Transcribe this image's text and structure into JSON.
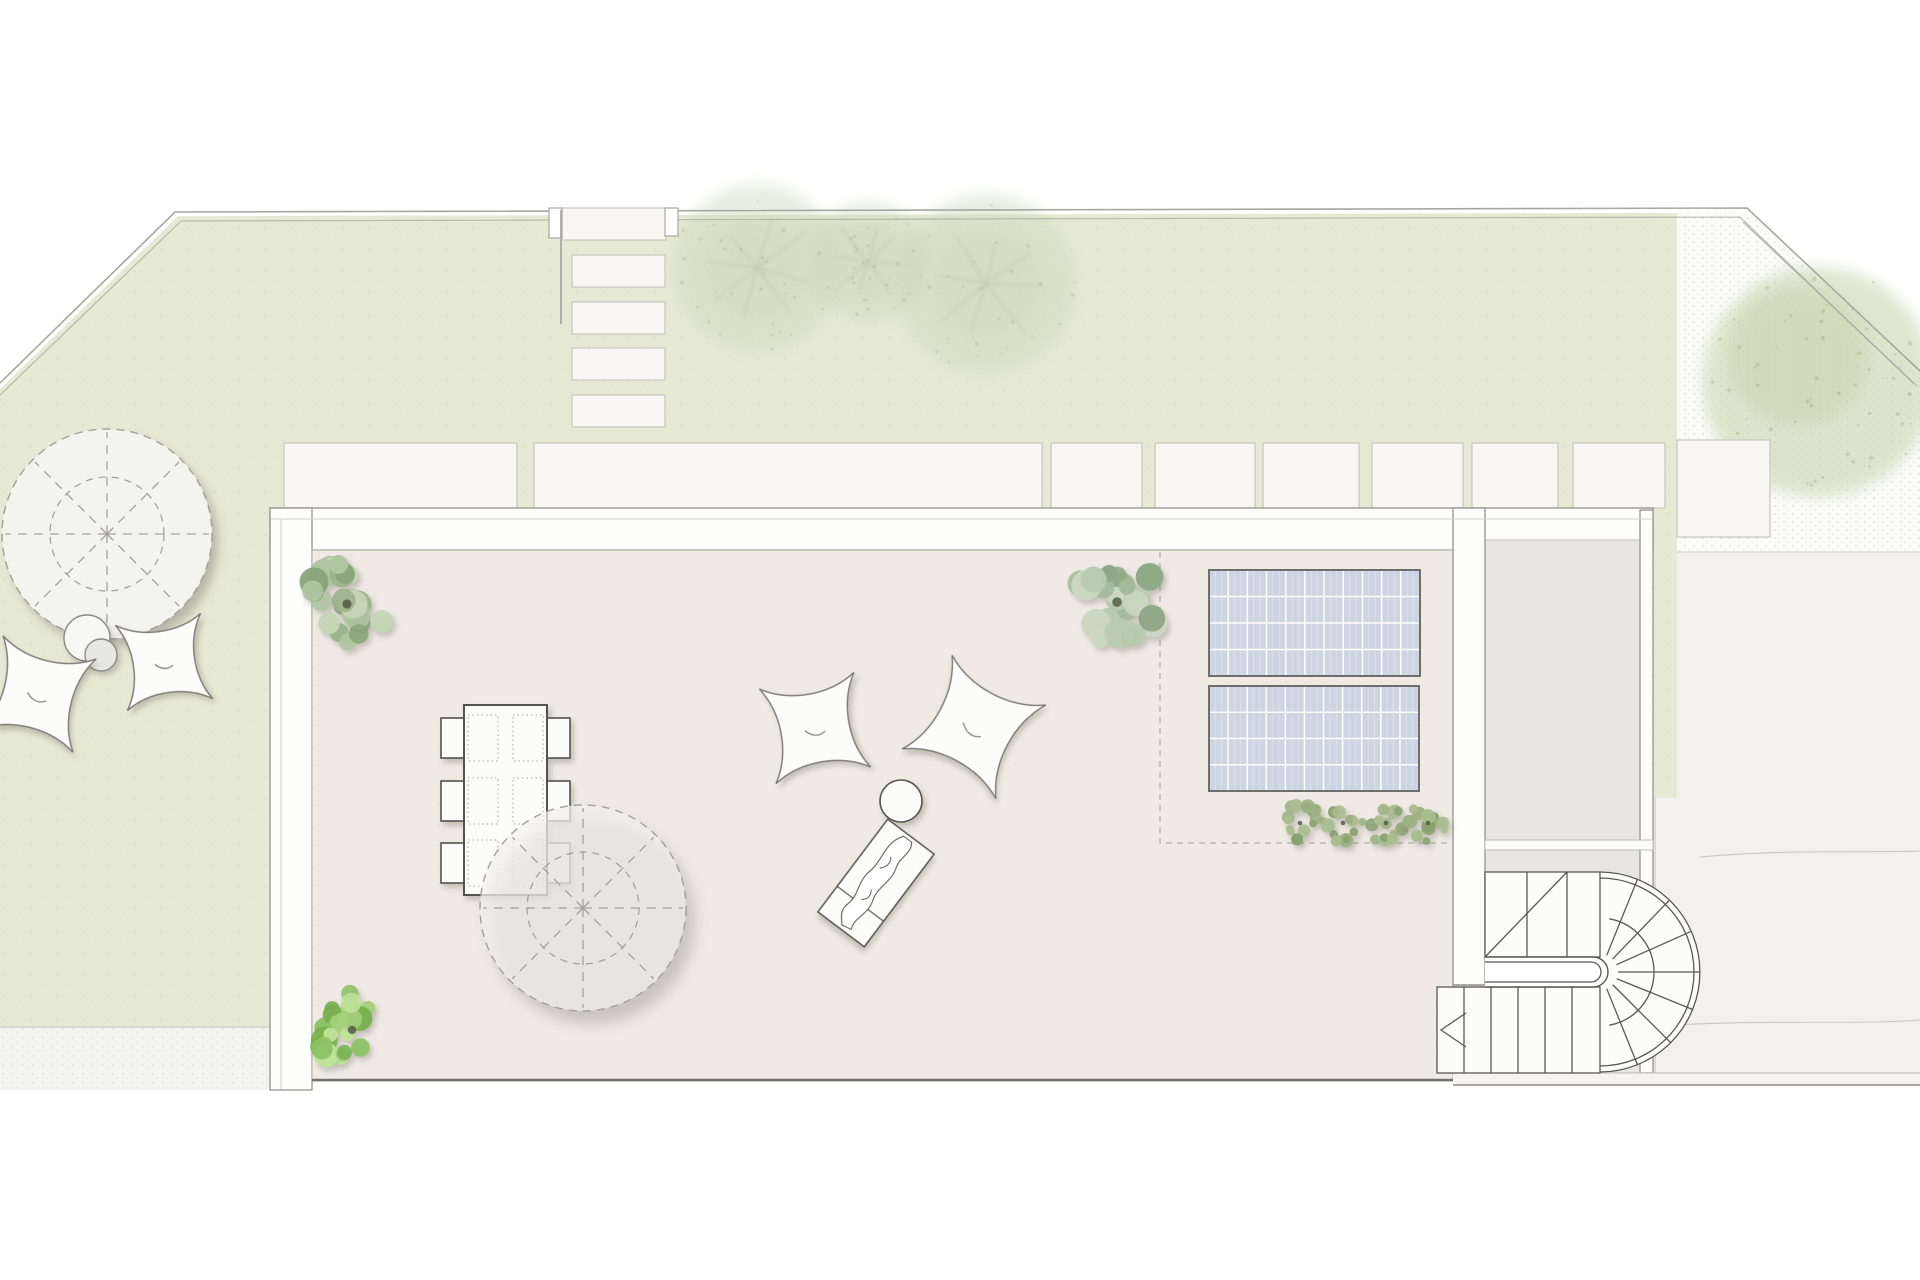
{
  "canvas": {
    "w": 1920,
    "h": 1280,
    "bg": "#ffffff"
  },
  "colors": {
    "lawn": "#e6e9d4",
    "boundary": "#a7a7a1",
    "paverFill": "#f8f7f3",
    "paverLine": "#c6c6c0",
    "gravelRight": "#fbfbf8",
    "gravelLeft": "#f3f4ee",
    "drive": "#f2f1ed",
    "driveLine": "#cbc9c4",
    "wallFill": "#fdfdfc",
    "wallLine": "#9b9b97",
    "wallInnerLine": "#d0cec9",
    "terraceFloor": "#efeae4",
    "annexFloor": "#e9e6e1",
    "floorEdge": "#b8b4ad",
    "darkEdge": "#74726e",
    "panelFill": "#ced5e2",
    "panelBorder": "#6e6e6c",
    "panelGrid": "#ffffff",
    "dashZone": "#b3b0a9",
    "furnLine": "#55534f",
    "furnFill": "#fcfcfa",
    "parasolDash": "#a3a29a",
    "parasolFillLawn": "#f4f4ee",
    "parasolFillTerrace": "rgba(243,241,234,0.72)",
    "treeSoftFill": "#cbd6b5",
    "treeSoftLine": "#a9ba92",
    "bigTreeFill": "#bfcfa2",
    "stair": "#5a5854",
    "shadow": "#6f6a5f"
  },
  "boundary": {
    "outer": "M 0 383 L 175 212 L 1747 208 L 1920 371",
    "inner": "M 0 395 L 181 221 L 1740 217 L 1914 384"
  },
  "lawn": {
    "points": "0,389 178,216 1677,213 1677,798 1655,798 1655,1027 0,1027"
  },
  "gravel_right": {
    "points": "1677,213 1747,210 1920,372 1920,552 1677,552",
    "inner_diag": "M 1743 222 L 1917 386"
  },
  "gravel_left": {
    "x": 0,
    "y": 1027,
    "w": 270,
    "h": 63
  },
  "driveway": {
    "x": 1677,
    "y": 552,
    "w": 243,
    "h": 533,
    "sliver": {
      "x": 1653,
      "y": 798,
      "w": 24,
      "h": 287
    },
    "top_line": "M 1677 552 L 1920 552",
    "seam1": "M 1700 857 C 1790 849 1862 853 1920 851",
    "seam2": "M 1655 1026 C 1770 1019 1852 1025 1920 1020",
    "vline": "M 1655 798 L 1655 1085"
  },
  "entry": {
    "steps": [
      {
        "x": 562,
        "y": 208,
        "w": 104,
        "h": 32
      },
      {
        "x": 572,
        "y": 255,
        "w": 93,
        "h": 32
      },
      {
        "x": 572,
        "y": 302,
        "w": 93,
        "h": 32
      },
      {
        "x": 572,
        "y": 348,
        "w": 93,
        "h": 32
      },
      {
        "x": 572,
        "y": 395,
        "w": 93,
        "h": 32
      }
    ],
    "gate_posts": [
      {
        "x": 549,
        "y": 208,
        "w": 13,
        "h": 30
      },
      {
        "x": 665,
        "y": 208,
        "w": 13,
        "h": 28
      }
    ],
    "retaining_line": "M 561 210 L 561 324"
  },
  "pavers": [
    {
      "x": 284,
      "y": 443,
      "w": 233,
      "h": 65
    },
    {
      "x": 534,
      "y": 443,
      "w": 508,
      "h": 65
    },
    {
      "x": 1051,
      "y": 443,
      "w": 91,
      "h": 65
    },
    {
      "x": 1155,
      "y": 443,
      "w": 100,
      "h": 65
    },
    {
      "x": 1263,
      "y": 443,
      "w": 96,
      "h": 65
    },
    {
      "x": 1372,
      "y": 443,
      "w": 91,
      "h": 65
    },
    {
      "x": 1472,
      "y": 443,
      "w": 86,
      "h": 65
    },
    {
      "x": 1573,
      "y": 443,
      "w": 92,
      "h": 65
    },
    {
      "x": 1677,
      "y": 440,
      "w": 93,
      "h": 97
    }
  ],
  "building": {
    "top_band": {
      "x": 270,
      "y": 508,
      "w": 1383,
      "h": 42
    },
    "left_band": {
      "x": 270,
      "y": 508,
      "w": 42,
      "h": 582
    },
    "mid_wall": {
      "x": 1453,
      "y": 508,
      "w": 32,
      "h": 477
    },
    "annex_right_wall": {
      "x": 1640,
      "y": 510,
      "w": 13,
      "h": 563
    },
    "terrace_floor": {
      "x": 312,
      "y": 550,
      "w": 1141,
      "h": 531
    },
    "annex_floor": {
      "x": 1485,
      "y": 540,
      "w": 155,
      "h": 533
    },
    "annex_band": {
      "x": 1485,
      "y": 840,
      "w": 168,
      "h": 10
    },
    "floor_patch": {
      "x": 1453,
      "y": 985,
      "w": 32,
      "h": 96
    },
    "inner_line_top": "M 271 519 L 1652 519",
    "inner_line_left": "M 281 519 L 281 1089",
    "mid_wall_cap": "M 1453 985 L 1485 985",
    "floor_bottom_line": "M 312 1080 L 1453 1080",
    "stair_bottom_band": {
      "x": 1453,
      "y": 1073,
      "w": 467,
      "h": 12
    }
  },
  "solar": {
    "zone_dash": "M 1160 552 L 1160 843 L 1453 843",
    "panels": [
      {
        "x": 1209,
        "y": 570,
        "w": 211,
        "h": 106
      },
      {
        "x": 1209,
        "y": 686,
        "w": 210,
        "h": 105
      }
    ],
    "cols": 11,
    "rows": 4
  },
  "trees_soft": [
    {
      "cx": 757,
      "cy": 268,
      "r": 84
    },
    {
      "cx": 868,
      "cy": 262,
      "r": 60
    },
    {
      "cx": 986,
      "cy": 284,
      "r": 90
    }
  ],
  "big_tree": {
    "cx": 1818,
    "cy": 382,
    "r": 115
  },
  "plants": [
    {
      "cx": 347,
      "cy": 604,
      "r": 46,
      "n": 26,
      "seed": 7,
      "palette": [
        "#9db58f",
        "#b0c5a1",
        "#87a478",
        "#c6d5b6"
      ]
    },
    {
      "cx": 352,
      "cy": 1030,
      "r": 42,
      "n": 24,
      "seed": 11,
      "palette": [
        "#8cc163",
        "#a5d07c",
        "#79b14e",
        "#c0e29a"
      ]
    },
    {
      "cx": 1117,
      "cy": 602,
      "r": 48,
      "n": 26,
      "seed": 23,
      "palette": [
        "#a3bb9a",
        "#b8cbaf",
        "#8fa887",
        "#cbd8c2"
      ]
    }
  ],
  "hedge": {
    "palette": [
      "#9cb183",
      "#a9bd8f",
      "#8aa271"
    ],
    "n": 14,
    "bushes": [
      {
        "cx": 1300,
        "cy": 823,
        "r": 23,
        "seed": 31
      },
      {
        "cx": 1343,
        "cy": 823,
        "r": 23,
        "seed": 37
      },
      {
        "cx": 1386,
        "cy": 823,
        "r": 23,
        "seed": 41
      },
      {
        "cx": 1428,
        "cy": 823,
        "r": 23,
        "seed": 43
      }
    ]
  },
  "parasols": [
    {
      "cx": 107,
      "cy": 534,
      "r": 105,
      "ri": 57,
      "on": "lawn"
    },
    {
      "cx": 583,
      "cy": 908,
      "r": 103,
      "ri": 56,
      "on": "terrace"
    }
  ],
  "side_tables": [
    {
      "cx": 87,
      "cy": 638,
      "r": 23,
      "fill": "#f7f7f3"
    },
    {
      "cx": 101,
      "cy": 655,
      "r": 16,
      "fill": "#e8e8e3"
    },
    {
      "cx": 901,
      "cy": 801,
      "r": 21,
      "fill": "#fbfbf9"
    }
  ],
  "bean_bags": [
    {
      "cx": 38,
      "cy": 694,
      "s": 48,
      "rot": 14
    },
    {
      "cx": 164,
      "cy": 662,
      "s": 43,
      "rot": -8
    },
    {
      "cx": 815,
      "cy": 728,
      "s": 48,
      "rot": -10
    },
    {
      "cx": 974,
      "cy": 727,
      "s": 53,
      "rot": 28
    }
  ],
  "dining": {
    "table": {
      "x": 464,
      "y": 705,
      "w": 83,
      "h": 190
    },
    "chair_w": 23,
    "chair_h": 40,
    "chair_rows_y": [
      718,
      781,
      843
    ],
    "left_chair_x": 441,
    "right_chair_x": 547,
    "pad_w": 30,
    "pad_h": 46,
    "pad_rows_y": [
      715,
      778,
      840
    ],
    "left_pad_x": 468,
    "right_pad_x": 513
  },
  "lounger": {
    "cx": 876,
    "cy": 883,
    "w": 58,
    "h": 116,
    "rot": 37,
    "divider_y": 26
  },
  "stair": {
    "upper": {
      "x": 1485,
      "y": 872,
      "w": 115,
      "h": 85,
      "treads": [
        1527,
        1567
      ],
      "diag": [
        1485,
        957,
        1567,
        872
      ]
    },
    "landing": {
      "x": 1485,
      "top": 957,
      "bot": 987,
      "cap_cx": 1593,
      "inner_top": 962,
      "inner_bot": 982,
      "inner_cap_cx": 1591
    },
    "fan": {
      "cx": 1600,
      "cy": 972,
      "r1": 100,
      "r2": 94,
      "inner_r": 54,
      "angles": [
        -68,
        -46,
        -24,
        0,
        22,
        45,
        68
      ]
    },
    "lower": {
      "x": 1437,
      "y": 987,
      "w": 163,
      "h": 86,
      "treads": [
        1464,
        1491,
        1518,
        1545,
        1572
      ]
    },
    "chevron": "M 1466 1013 L 1441 1030 L 1466 1047"
  }
}
